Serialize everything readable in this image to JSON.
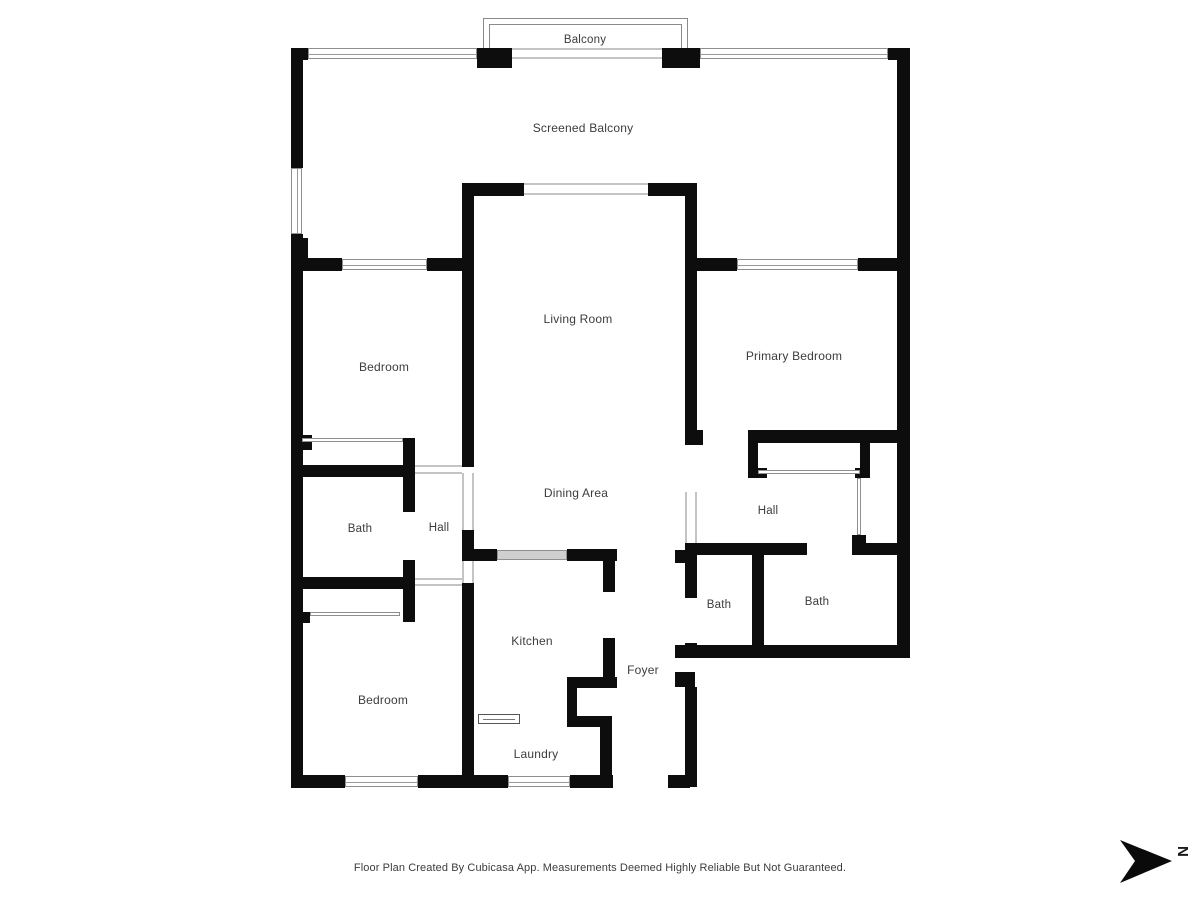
{
  "rooms": [
    {
      "label": "Balcony"
    },
    {
      "label": "Screened Balcony"
    },
    {
      "label": "Living Room"
    },
    {
      "label": "Bedroom"
    },
    {
      "label": "Primary Bedroom"
    },
    {
      "label": "Dining Area"
    },
    {
      "label": "Hall"
    },
    {
      "label": "Bath"
    },
    {
      "label": "Hall"
    },
    {
      "label": "Bath"
    },
    {
      "label": "Bath"
    },
    {
      "label": "Kitchen"
    },
    {
      "label": "Foyer"
    },
    {
      "label": "Bedroom"
    },
    {
      "label": "Laundry"
    }
  ],
  "footer": {
    "disclaimer": "Floor Plan Created By Cubicasa App. Measurements Deemed Highly Reliable But Not Guaranteed."
  },
  "compass": {
    "north_label": "N"
  },
  "colors": {
    "wall": "#0d0d0d",
    "label_text": "#3c3c3c",
    "window_line": "#8f8f8f",
    "opening_line": "#c4c4c4"
  }
}
